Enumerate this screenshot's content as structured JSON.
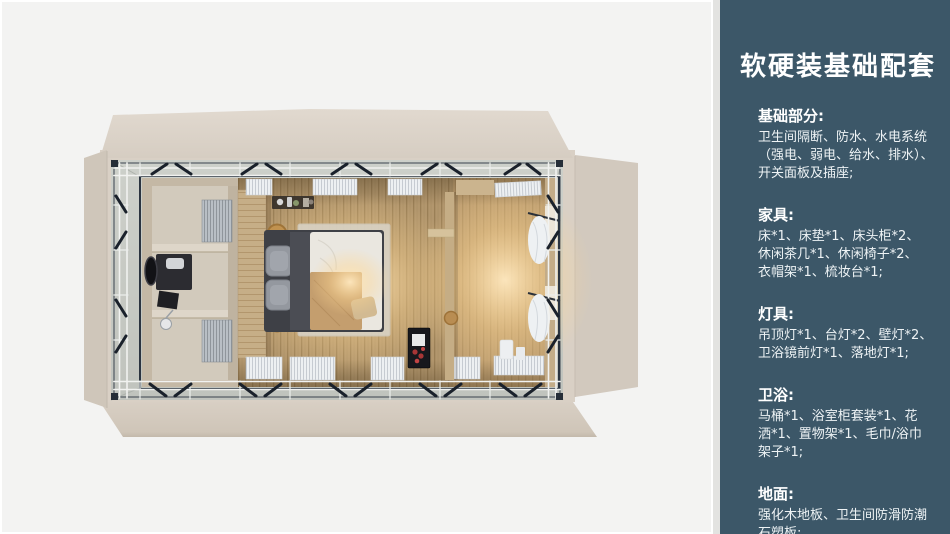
{
  "panel": {
    "title": "软硬装基础配套",
    "bg_color": "#3c5768",
    "text_color": "#ffffff",
    "sections": [
      {
        "heading": "基础部分:",
        "lines": [
          "卫生间隔断、防水、水电系统",
          "（强电、弱电、给水、排水）、",
          "开关面板及插座;"
        ]
      },
      {
        "heading": "家具:",
        "lines": [
          "床*1、床垫*1、床头柜*2、",
          "休闲茶几*1、休闲椅子*2、",
          "衣帽架*1、梳妆台*1;"
        ]
      },
      {
        "heading": "灯具:",
        "lines": [
          "吊顶灯*1、台灯*2、壁灯*2、",
          "卫浴镜前灯*1、落地灯*1;"
        ]
      },
      {
        "heading": "卫浴:",
        "lines": [
          "马桶*1、浴室柜套装*1、花",
          "洒*1、置物架*1、毛巾/浴巾",
          "架子*1;"
        ]
      },
      {
        "heading": "地面:",
        "lines": [
          "强化木地板、卫生间防滑防潮",
          "石塑板;"
        ]
      }
    ]
  },
  "floorplan": {
    "canvas_bg": "#f3f3f2",
    "shell_beige": "#d9d0c5",
    "frame_band_gray": "#c7cac4",
    "frame_dark": "#2b3440",
    "wood_floor": "#b2966d",
    "warm_glow": "#ffe9c0",
    "bed_duvet": "#eae7e0",
    "bed_throw": "#c49e6e",
    "bathroom_beige": "#cbc0af"
  }
}
